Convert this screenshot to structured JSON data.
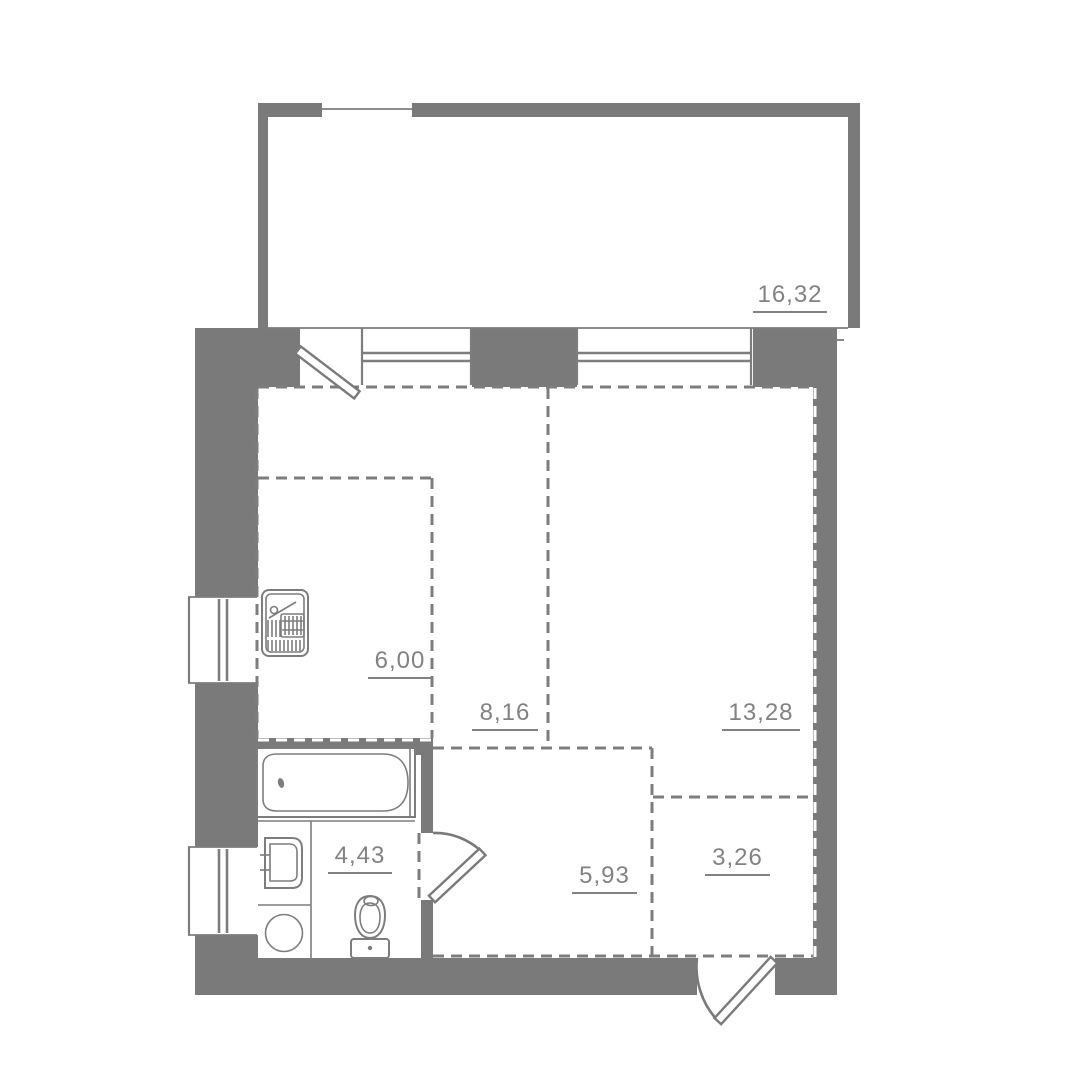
{
  "plan": {
    "title": "apartment-floor-plan",
    "rooms": [
      {
        "id": "balcony",
        "area": "16,32"
      },
      {
        "id": "kitchen",
        "area": "6,00"
      },
      {
        "id": "room",
        "area": "8,16"
      },
      {
        "id": "living",
        "area": "13,28"
      },
      {
        "id": "bathroom",
        "area": "4,43"
      },
      {
        "id": "hallway",
        "area": "5,93"
      },
      {
        "id": "wardrobe",
        "area": "3,26"
      }
    ],
    "colors": {
      "wall": "#7a7a7a",
      "line": "#7d7d7d",
      "label": "#828282",
      "background": "#ffffff"
    }
  }
}
